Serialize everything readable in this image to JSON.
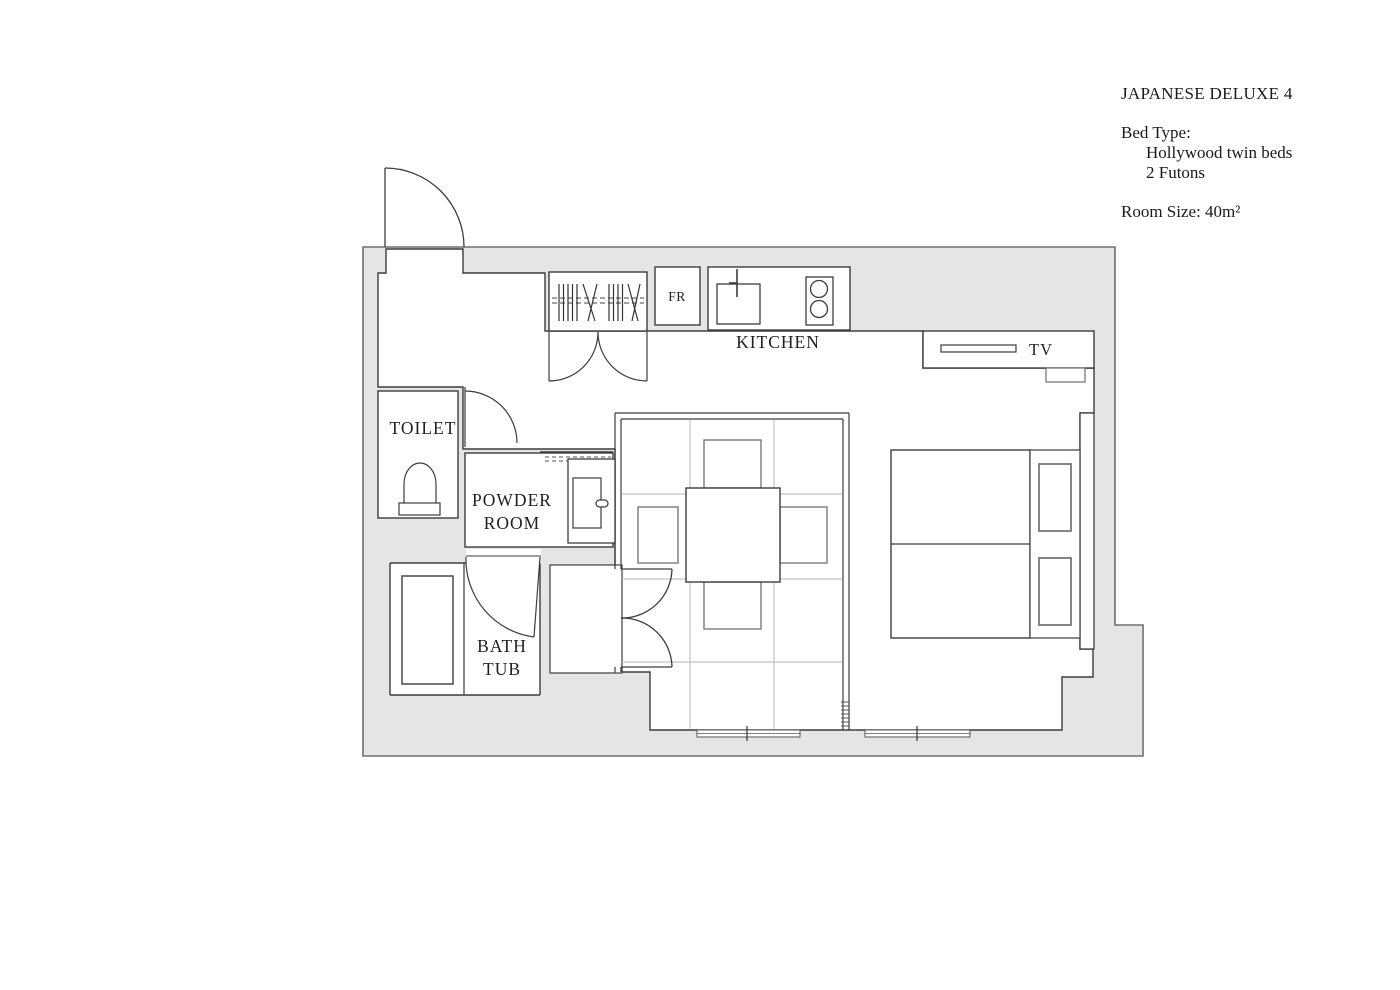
{
  "info": {
    "title": "JAPANESE DELUXE 4",
    "bed_type_label": "Bed Type:",
    "bed_type_items": [
      "Hollywood twin beds",
      "2 Futons"
    ],
    "room_size": "Room Size: 40m²"
  },
  "rooms": {
    "toilet": "TOILET",
    "powder_room_line1": "POWDER",
    "powder_room_line2": "ROOM",
    "bath_line1": "BATH",
    "bath_line2": "TUB",
    "kitchen": "KITCHEN"
  },
  "appliances": {
    "fridge": "FR",
    "tv": "TV"
  },
  "colors": {
    "background": "#ffffff",
    "wall_fill": "#e5e5e5",
    "wall_outline": "#707070",
    "line": "#3d3d3d",
    "furniture_line": "#6f6f6f",
    "grid_line": "#c3c3c3",
    "text": "#1f1f1f"
  }
}
